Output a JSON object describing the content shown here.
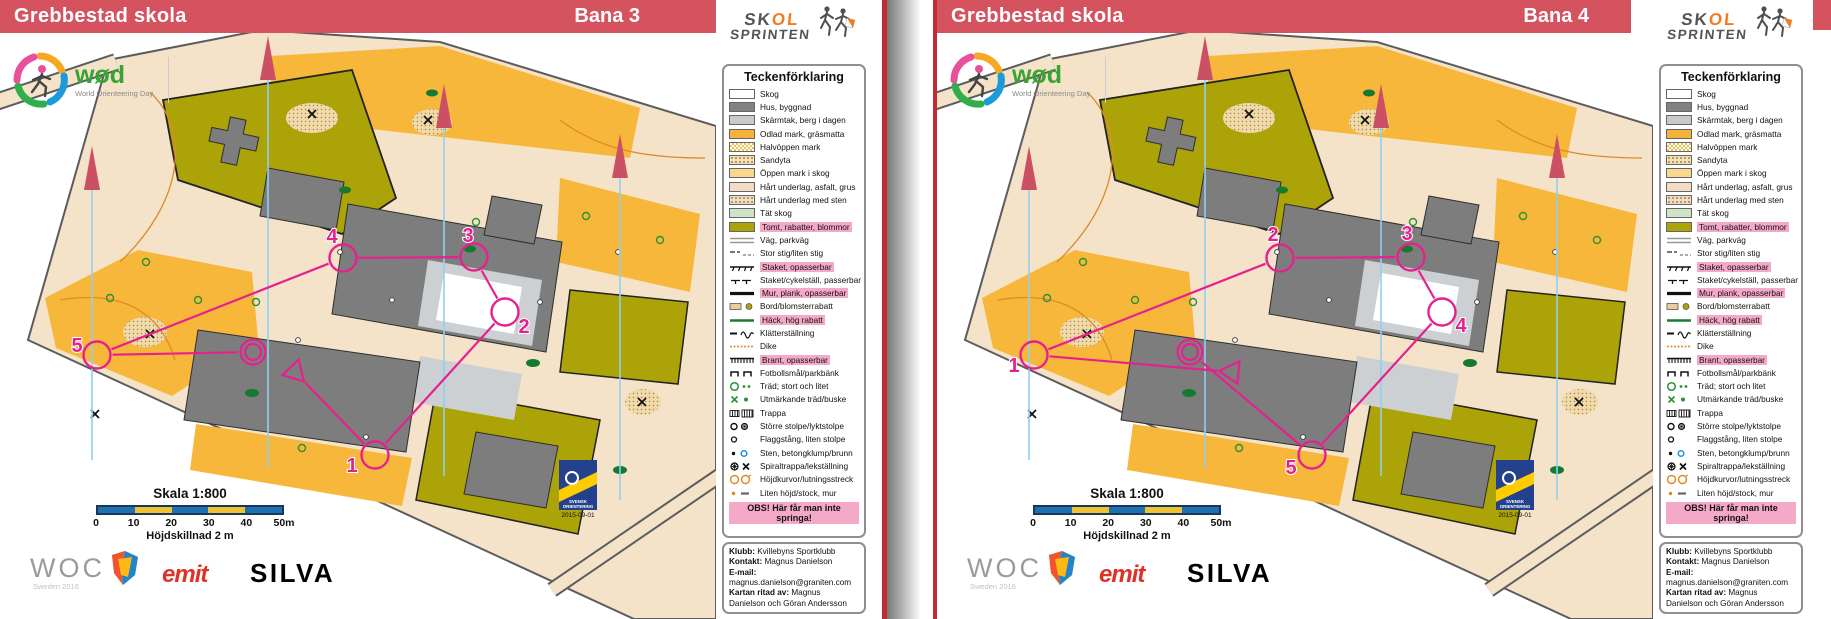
{
  "pages": [
    {
      "header": {
        "school": "Grebbestad skola",
        "course": "Bana 3"
      },
      "course": {
        "start": {
          "x": 295,
          "y": 372
        },
        "finish": {
          "x": 253,
          "y": 352
        },
        "controls": [
          {
            "num": "1",
            "x": 375,
            "y": 455,
            "lx": 352,
            "ly": 472
          },
          {
            "num": "2",
            "x": 505,
            "y": 312,
            "lx": 524,
            "ly": 333
          },
          {
            "num": "3",
            "x": 474,
            "y": 257,
            "lx": 468,
            "ly": 242
          },
          {
            "num": "4",
            "x": 343,
            "y": 258,
            "lx": 332,
            "ly": 243
          },
          {
            "num": "5",
            "x": 97,
            "y": 355,
            "lx": 77,
            "ly": 352
          }
        ]
      }
    },
    {
      "header": {
        "school": "Grebbestad skola",
        "course": "Bana 4"
      },
      "course": {
        "start": {
          "x": 295,
          "y": 372
        },
        "finish": {
          "x": 253,
          "y": 352
        },
        "controls": [
          {
            "num": "1",
            "x": 97,
            "y": 355,
            "lx": 77,
            "ly": 372
          },
          {
            "num": "2",
            "x": 343,
            "y": 258,
            "lx": 336,
            "ly": 241
          },
          {
            "num": "3",
            "x": 474,
            "y": 257,
            "lx": 470,
            "ly": 240
          },
          {
            "num": "4",
            "x": 505,
            "y": 312,
            "lx": 524,
            "ly": 332
          },
          {
            "num": "5",
            "x": 375,
            "y": 455,
            "lx": 354,
            "ly": 474
          }
        ]
      }
    }
  ],
  "shared": {
    "skol_logo": {
      "line1_dark": "SK",
      "line1_orange": "OL",
      "line2": "SPRINTEN"
    },
    "wod_logo": {
      "wordmark": "wød",
      "subtitle": "World Orienteering Day"
    },
    "legend": {
      "title": "Teckenförklaring",
      "items": [
        {
          "label": "Skog",
          "icon": "skog-swatch"
        },
        {
          "label": "Hus, byggnad",
          "icon": "hus-swatch"
        },
        {
          "label": "Skärmtak, berg i dagen",
          "icon": "skarmtak-swatch"
        },
        {
          "label": "Odlad mark, gräsmatta",
          "icon": "odlad-swatch"
        },
        {
          "label": "Halvöppen mark",
          "icon": "halvoppen-swatch"
        },
        {
          "label": "Sandyta",
          "icon": "sandyta-swatch"
        },
        {
          "label": "Öppen mark i skog",
          "icon": "oppenmark-swatch"
        },
        {
          "label": "Hårt underlag, asfalt, grus",
          "icon": "hartunderlag-swatch"
        },
        {
          "label": "Hårt underlag med sten",
          "icon": "hartsten-swatch"
        },
        {
          "label": "Tät skog",
          "icon": "tatskog-swatch"
        },
        {
          "label": "Tomt, rabatter, blommor",
          "icon": "tomt-swatch",
          "hl": true
        },
        {
          "label": "Väg, parkväg",
          "icon": "vag-line"
        },
        {
          "label": "Stor stig/liten stig",
          "icon": "stig-line"
        },
        {
          "label": "Staket, opasserbar",
          "icon": "staket-opasserbar-line",
          "hl": true
        },
        {
          "label": "Staket/cykelställ, passerbar",
          "icon": "staket-passerbar-line"
        },
        {
          "label": "Mur, plank, opasserbar",
          "icon": "mur-line",
          "hl": true
        },
        {
          "label": "Bord/blomsterrabatt",
          "icon": "bord-symbol"
        },
        {
          "label": "Häck, hög rabatt",
          "icon": "hack-line",
          "hl": true
        },
        {
          "label": "Klätterställning",
          "icon": "klatterstallning-symbol"
        },
        {
          "label": "Dike",
          "icon": "dike-line"
        },
        {
          "label": "Brant, opasserbar",
          "icon": "brant-line",
          "hl": true
        },
        {
          "label": "Fotbollsmål/parkbänk",
          "icon": "fotbollsmal-symbol"
        },
        {
          "label": "Träd; stort och litet",
          "icon": "trad-symbol"
        },
        {
          "label": "Utmärkande träd/buske",
          "icon": "utmarkande-trad-symbol"
        },
        {
          "label": "Trappa",
          "icon": "trappa-symbol"
        },
        {
          "label": "Större stolpe/lyktstolpe",
          "icon": "stolpe-symbol"
        },
        {
          "label": "Flaggstång, liten stolpe",
          "icon": "flaggstang-symbol"
        },
        {
          "label": "Sten, betongklump/brunn",
          "icon": "sten-brunn-symbol"
        },
        {
          "label": "Spiraltrappa/lekställning",
          "icon": "spiraltrappa-symbol"
        },
        {
          "label": "Höjdkurvor/lutningsstreck",
          "icon": "hojdkurvor-symbol"
        },
        {
          "label": "Liten höjd/stock, mur",
          "icon": "litenhojd-symbol"
        }
      ],
      "warning": "OBS! Här får man inte springa!"
    },
    "club": {
      "klubb_label": "Klubb:",
      "klubb": "Kvillebyns Sportklubb",
      "kontakt_label": "Kontakt:",
      "kontakt": "Magnus Danielson",
      "email_label": "E-mail:",
      "email": "magnus.danielson@graniten.com",
      "ritad_label": "Kartan ritad av:",
      "ritad": "Magnus Danielson och Göran Andersson"
    },
    "scale": {
      "title": "Skala 1:800",
      "ticks": [
        "0",
        "10",
        "20",
        "30",
        "40",
        "50m"
      ],
      "subtitle": "Höjdskillnad 2 m"
    },
    "sponsors": {
      "woc": "WOC",
      "woc_sub": "Sweden 2016",
      "emit": "emit",
      "silva": "SILVA"
    },
    "federation": {
      "name": "SVENSK ORIENTERING",
      "date": "2015-09-01"
    },
    "colors": {
      "banner_red": "#d5525f",
      "course_magenta": "#e6218f",
      "legend_highlight_pink": "#f5a9c9",
      "scale_blue": "#2170ae",
      "scale_yellow": "#f1c232"
    }
  }
}
